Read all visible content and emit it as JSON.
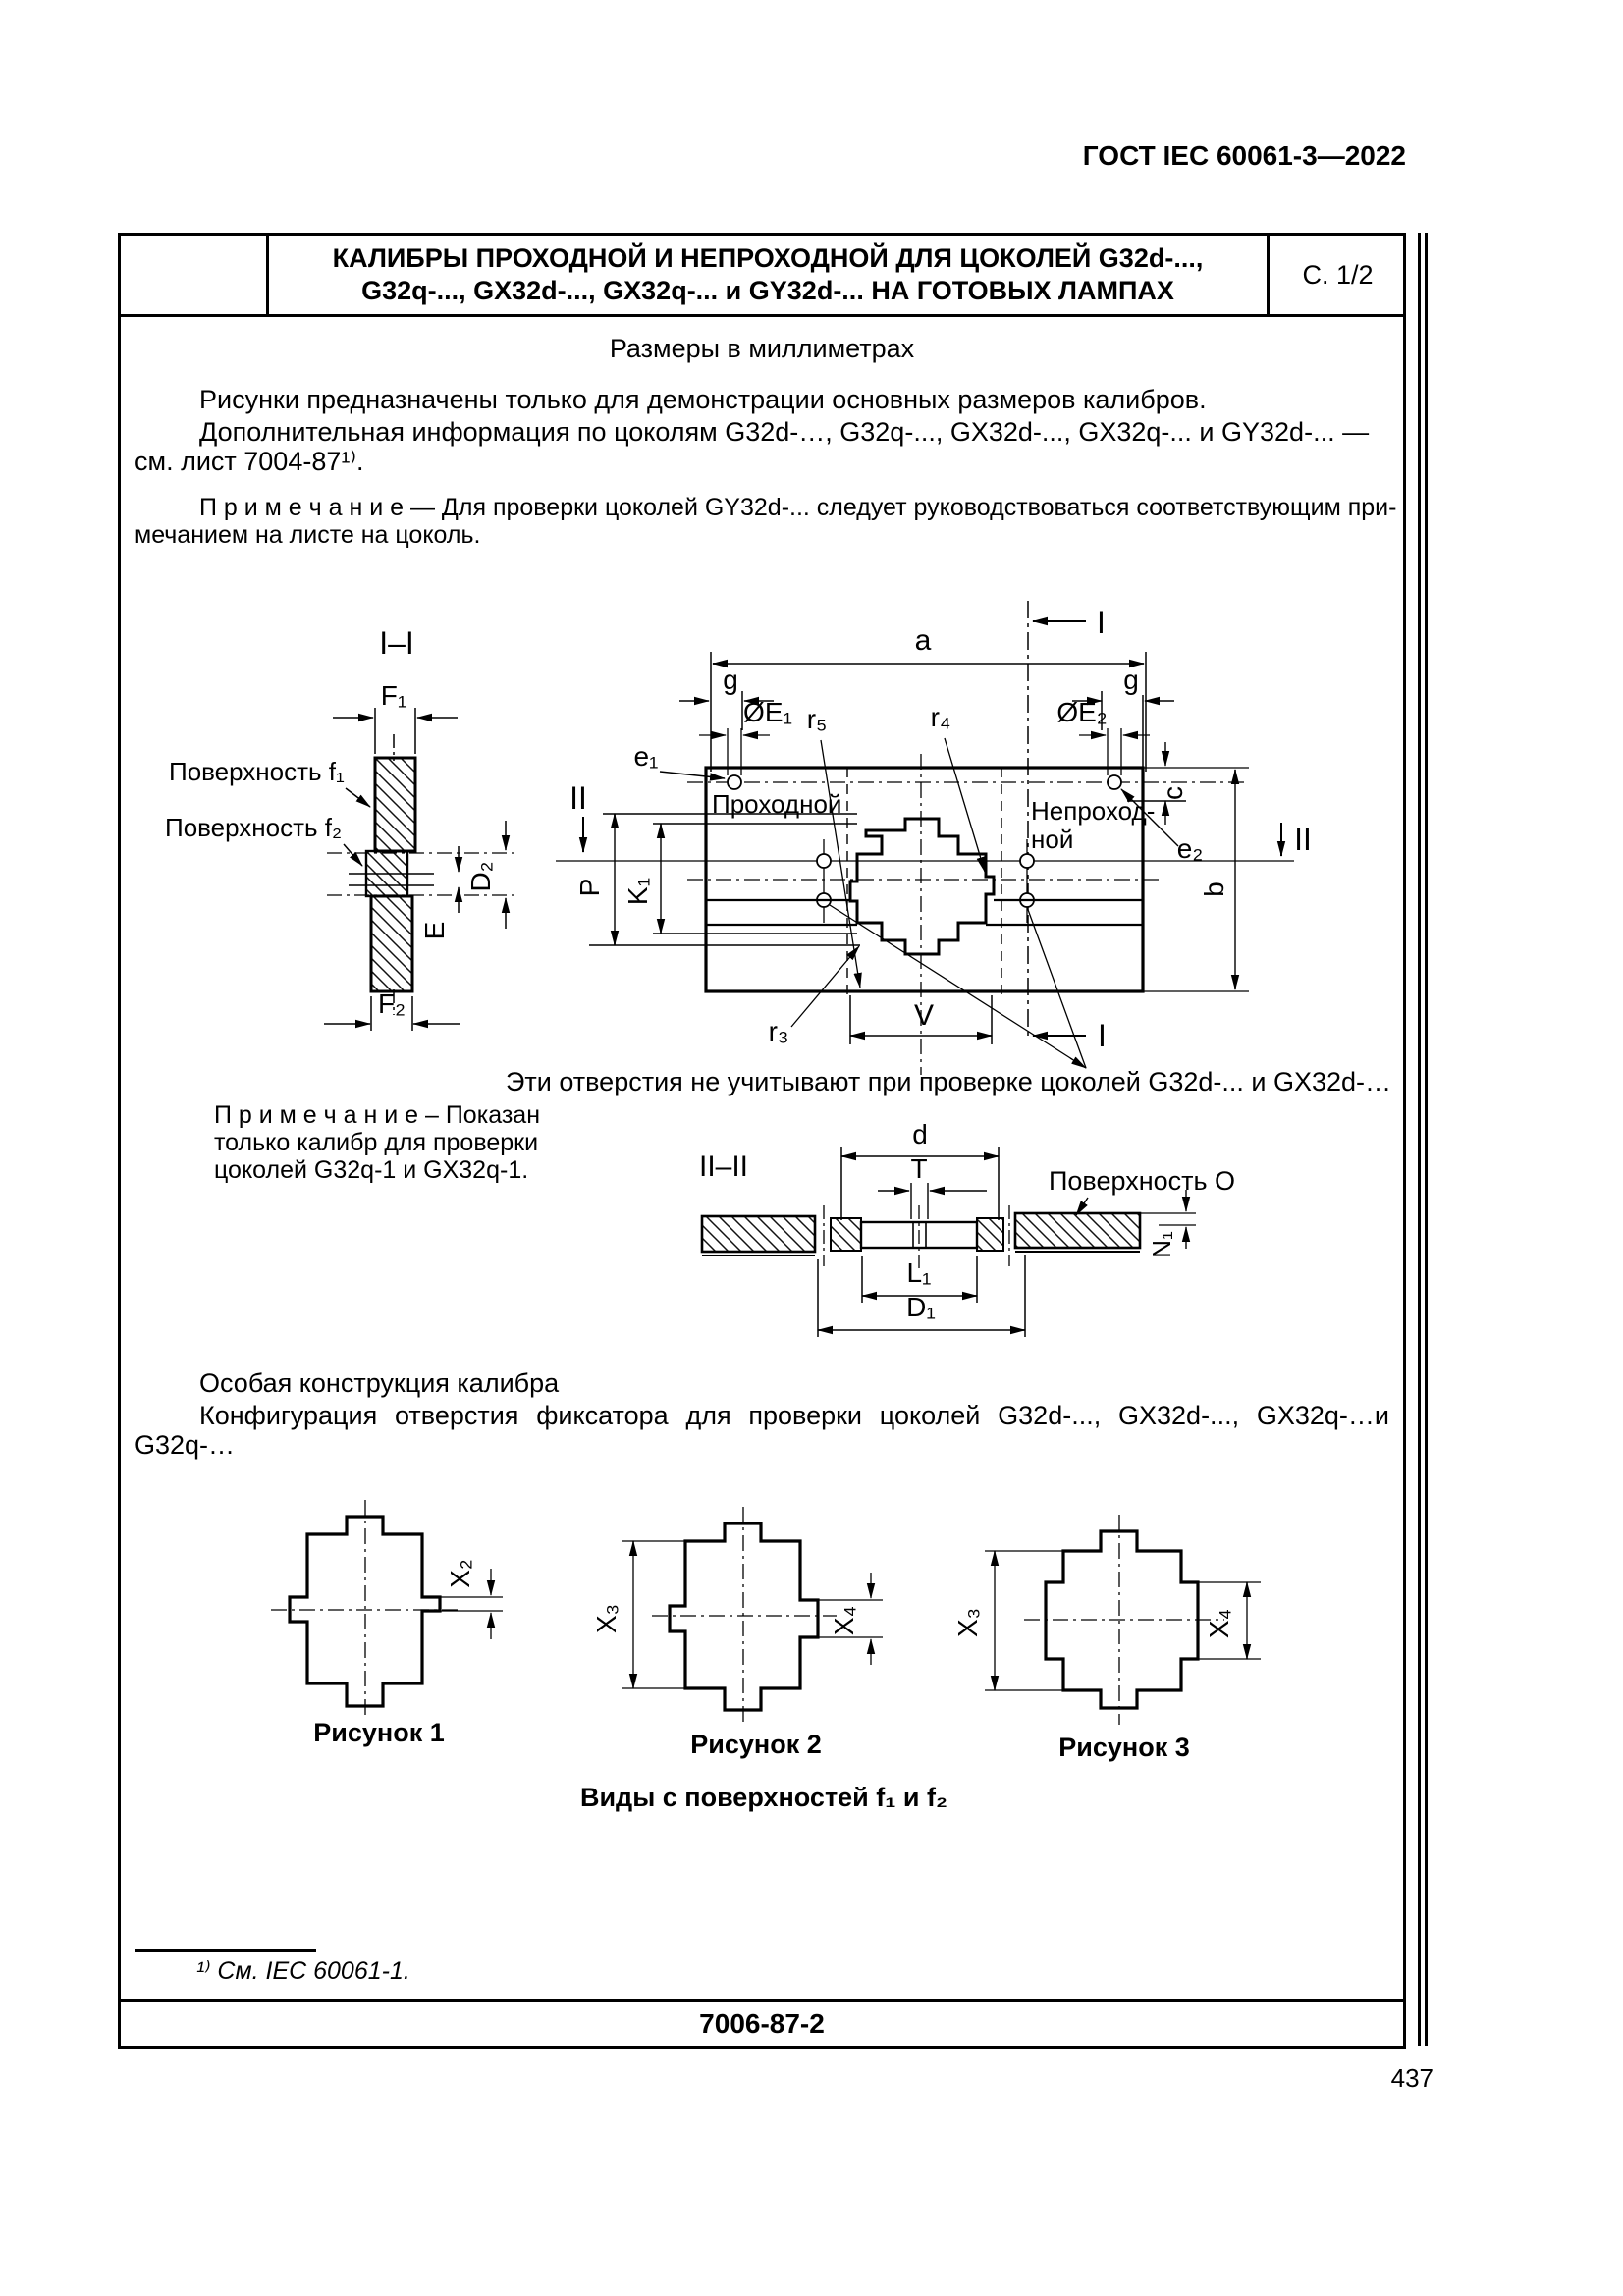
{
  "header": {
    "standard": "ГОСТ IEC 60061-3—2022"
  },
  "title_block": {
    "line1": "КАЛИБРЫ ПРОХОДНОЙ И НЕПРОХОДНОЙ ДЛЯ ЦОКОЛЕЙ G32d-...,",
    "line2": "G32q-..., GX32d-..., GX32q-... и GY32d-... НА ГОТОВЫХ ЛАМПАХ",
    "sheet": "С. 1/2"
  },
  "intro": {
    "units": "Размеры в миллиметрах",
    "p1": "Рисунки предназначены только для демонстрации основных размеров калибров.",
    "p2a": "Дополнительная информация по цоколям G32d-…, G32q-..., GX32d-..., GX32q-... и GY32d-... —",
    "p2b": "см. лист 7004-87¹⁾.",
    "note1": "П р и м е ч а н и е — Для проверки цоколей GY32d-... следует руководствоваться соответствующим при-",
    "note2": "мечанием на листе на цоколь."
  },
  "sec1": {
    "title": "I–I",
    "f1": "F₁",
    "f2": "F₂",
    "d2": "D₂",
    "e": "E",
    "surf1": "Поверхность f₁",
    "surf2": "Поверхность f₂"
  },
  "plan": {
    "a": "a",
    "g_left": "g",
    "g_right": "g",
    "oe1": "ØE₁",
    "oe2": "ØE₂",
    "r3": "r₃",
    "r4": "r₄",
    "r5": "r₅",
    "e1": "e₁",
    "e2": "e₂",
    "c": "c",
    "b": "b",
    "p": "P",
    "k1": "K₁",
    "v": "V",
    "i_top": "I",
    "i_bottom": "I",
    "ii_left": "II",
    "ii_right": "II",
    "pass": "Проходной",
    "nopass1": "Непроход-",
    "nopass2": "ной"
  },
  "holes_note": "Эти отверстия не учитывают при проверке цоколей G32d-... и GX32d-…",
  "gauge_note": {
    "line1": "П р и м е ч а н и е – Показан",
    "line2": "только калибр для проверки",
    "line3": "цоколей G32q-1 и GX32q-1."
  },
  "sec2": {
    "title": "II–II",
    "d": "d",
    "t": "T",
    "l1": "L₁",
    "d1": "D₁",
    "n1": "N₁",
    "surf_o": "Поверхность О"
  },
  "special": {
    "heading": "Особая конструкция калибра",
    "body": "Конфигурация отверстия фиксатора для проверки цоколей G32d-..., GX32d-..., GX32q-…и G32q-…"
  },
  "figures": {
    "cap1": "Рисунок 1",
    "cap2": "Рисунок 2",
    "cap3": "Рисунок 3",
    "x2": "X₂",
    "x3_fig2": "X₃",
    "x4_fig2": "X₄",
    "x3_fig3": "X₃",
    "x4_fig3": "X₄",
    "views": "Виды с поверхностей f₁ и f₂"
  },
  "footer": {
    "footnote": "¹⁾ См. IEC 60061-1.",
    "doc_number": "7006-87-2",
    "page": "437"
  }
}
